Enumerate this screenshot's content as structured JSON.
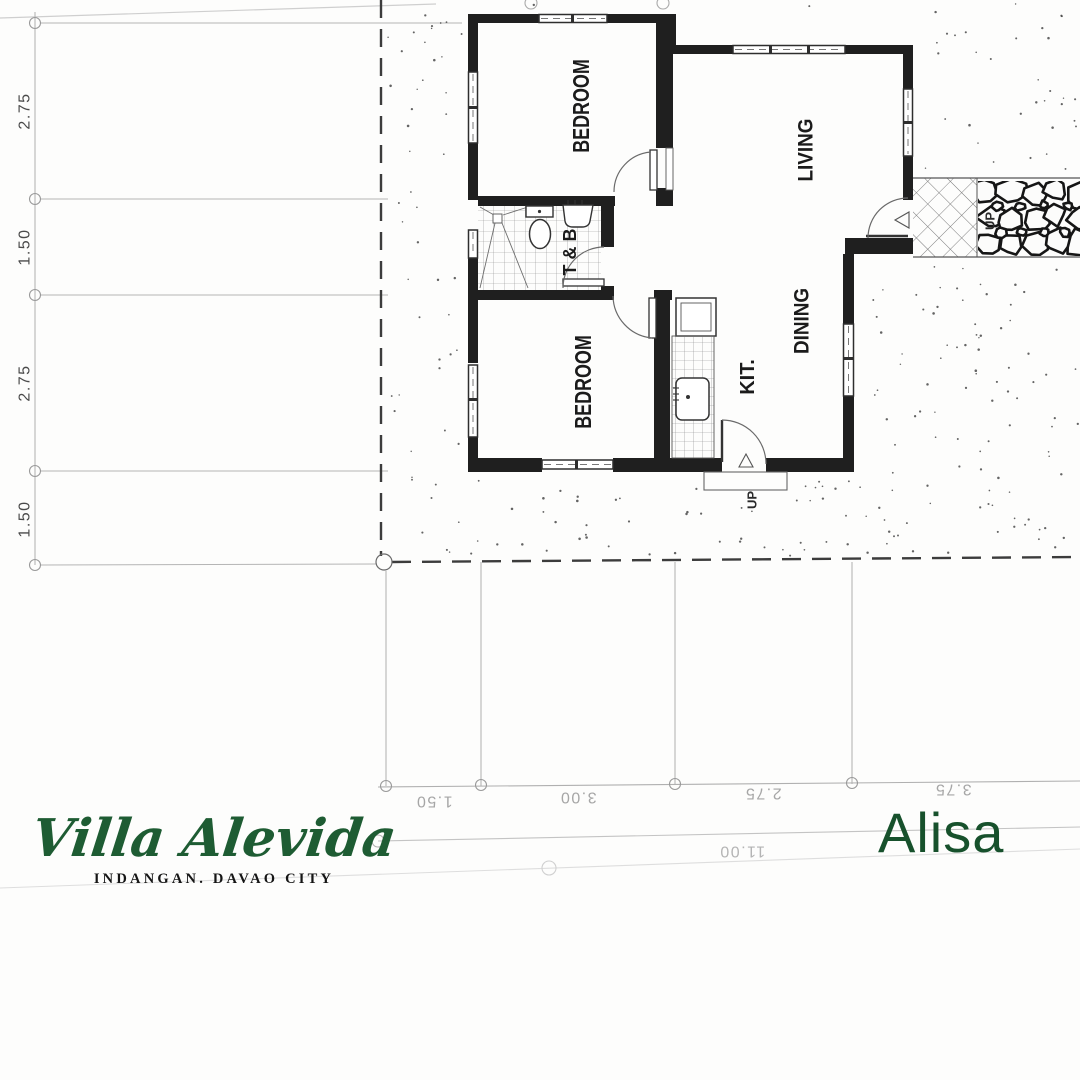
{
  "brand": {
    "name": "Villa Alevida",
    "location": "INDANGAN. DAVAO CITY",
    "accent_green": "#1e5c33"
  },
  "unit": {
    "name": "Alisa",
    "color": "#17512c"
  },
  "floor_plan": {
    "rooms": [
      {
        "id": "bedroom-1",
        "label": "BEDROOM"
      },
      {
        "id": "toilet-bath",
        "label": "T & B"
      },
      {
        "id": "bedroom-2",
        "label": "BEDROOM"
      },
      {
        "id": "living",
        "label": "LIVING"
      },
      {
        "id": "dining",
        "label": "DINING"
      },
      {
        "id": "kitchen",
        "label": "KIT."
      }
    ],
    "stairs": {
      "porch_up": "UP",
      "kitchen_up": "UP"
    },
    "dimensions": {
      "left": [
        "2.75",
        "1.50",
        "2.75",
        "1.50"
      ],
      "bottom": [
        "1.50",
        "3.00",
        "2.75",
        "3.75"
      ],
      "bottom_total": "11.00"
    },
    "wall_color": "#1f1f1f",
    "grid_color": "#b5b5b5"
  }
}
